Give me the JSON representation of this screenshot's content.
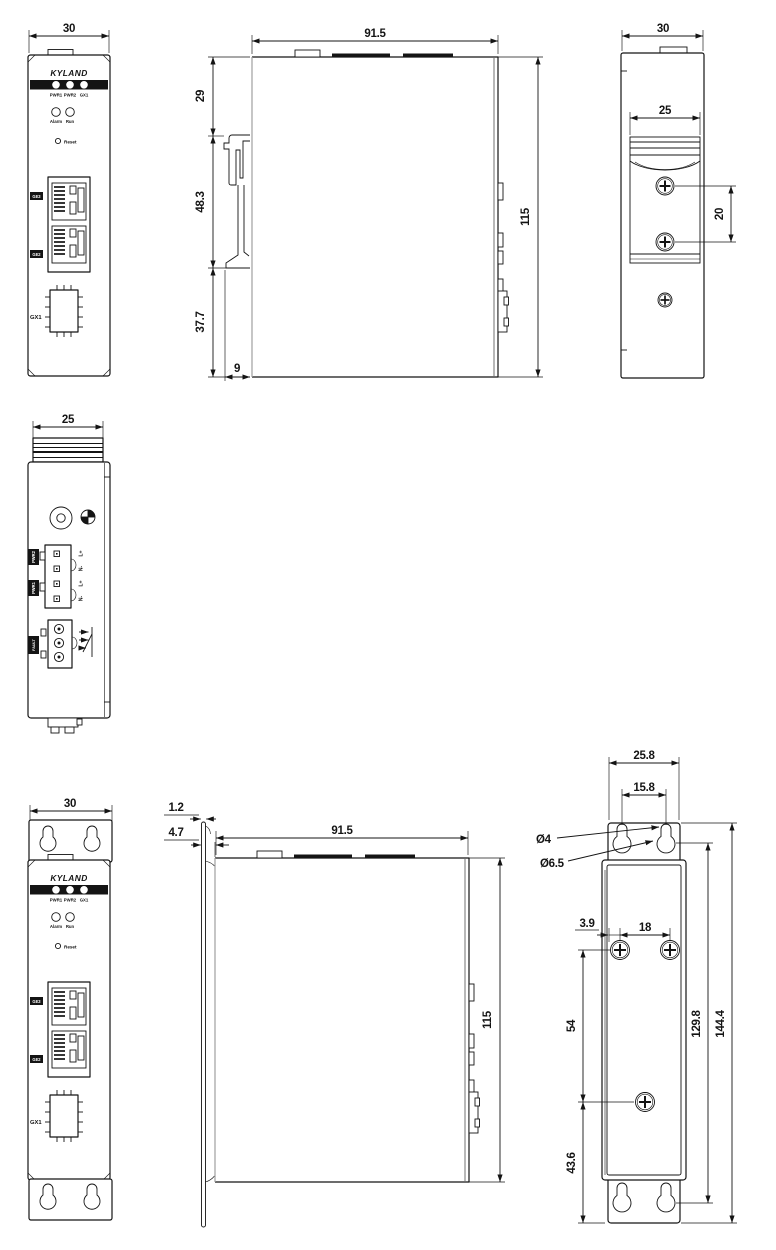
{
  "brand": "KYLAND",
  "panel": {
    "led1": "PWR1",
    "led2": "PWR2",
    "led3": "GX1",
    "alarm": "Alarm",
    "run": "Run",
    "reset": "Reset",
    "ge3": "GE3",
    "ge2": "GE2",
    "gx1": "GX1"
  },
  "front_din": {
    "width": "30"
  },
  "side_din": {
    "width": "91.5",
    "height": "115",
    "seg_top": "29",
    "seg_mid": "48.3",
    "seg_bottom": "37.7",
    "depth": "9"
  },
  "rear_din": {
    "width": "30",
    "rail": "25",
    "pitch": "20"
  },
  "top_view": {
    "width": "25",
    "pwr2": "PWR2",
    "pwr1": "PWR1",
    "fault": "FAULT",
    "pin1": "L+",
    "pin2": "N-",
    "pin3": "L+",
    "pin4": "N-"
  },
  "front_wall": {
    "width": "30"
  },
  "side_wall": {
    "thickness": "1.2",
    "offset": "4.7",
    "width": "91.5",
    "height": "115"
  },
  "rear_wall": {
    "width": "25.8",
    "hole_pitch": "15.8",
    "slot_dia": "Ø4",
    "hole_dia": "Ø6.5",
    "edge": "3.9",
    "pitch_h": "18",
    "pitch_v": "54",
    "span": "129.8",
    "total": "144.4",
    "bottom": "43.6"
  }
}
